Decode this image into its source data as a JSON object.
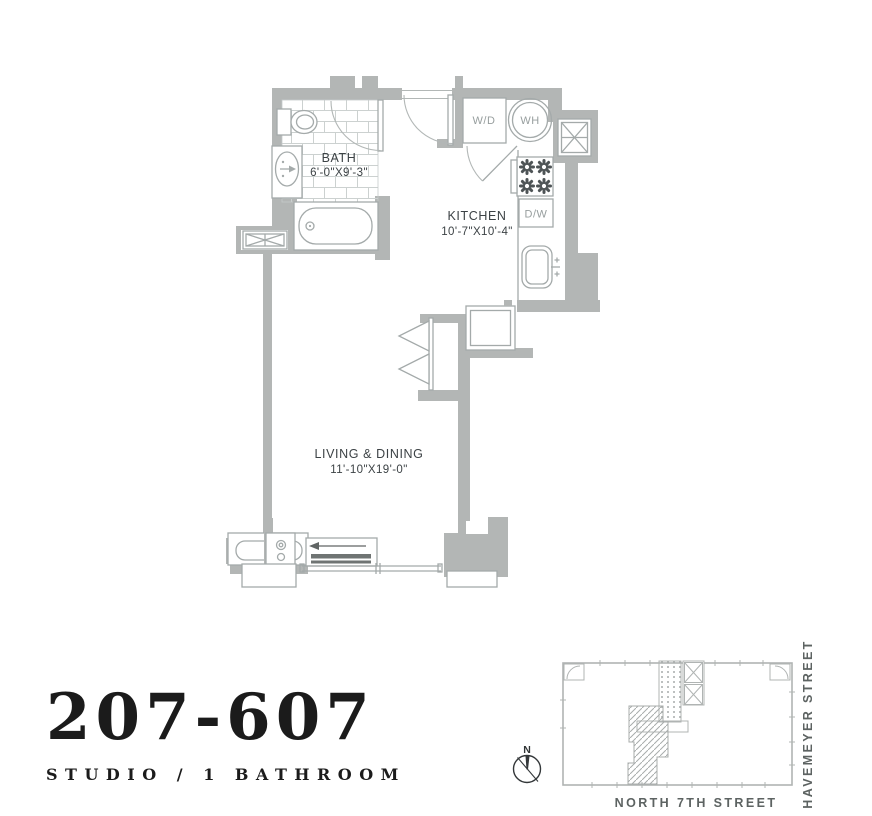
{
  "unit": {
    "number": "207-607",
    "type": "STUDIO / 1 BATHROOM"
  },
  "rooms": {
    "bath": {
      "name": "BATH",
      "dims": "6'-0\"X9'-3\""
    },
    "kitchen": {
      "name": "KITCHEN",
      "dims": "10'-7\"X10'-4\""
    },
    "living": {
      "name": "LIVING & DINING",
      "dims": "11'-10\"X19'-0\""
    }
  },
  "appliances": {
    "washer_dryer": "W/D",
    "water_heater": "WH",
    "dishwasher": "D/W"
  },
  "site_plan": {
    "street_bottom": "NORTH 7TH STREET",
    "street_right": "HAVEMEYER STREET",
    "compass_north": "N"
  },
  "colors": {
    "wall_gray": "#b3b6b5",
    "fixture_line": "#a4aaaa",
    "tile_line": "#ccd1d0",
    "room_label": "#3c4245",
    "appliance_label": "#979e9e",
    "street_label": "#5d6362",
    "title_ink": "#1b1b1b"
  }
}
